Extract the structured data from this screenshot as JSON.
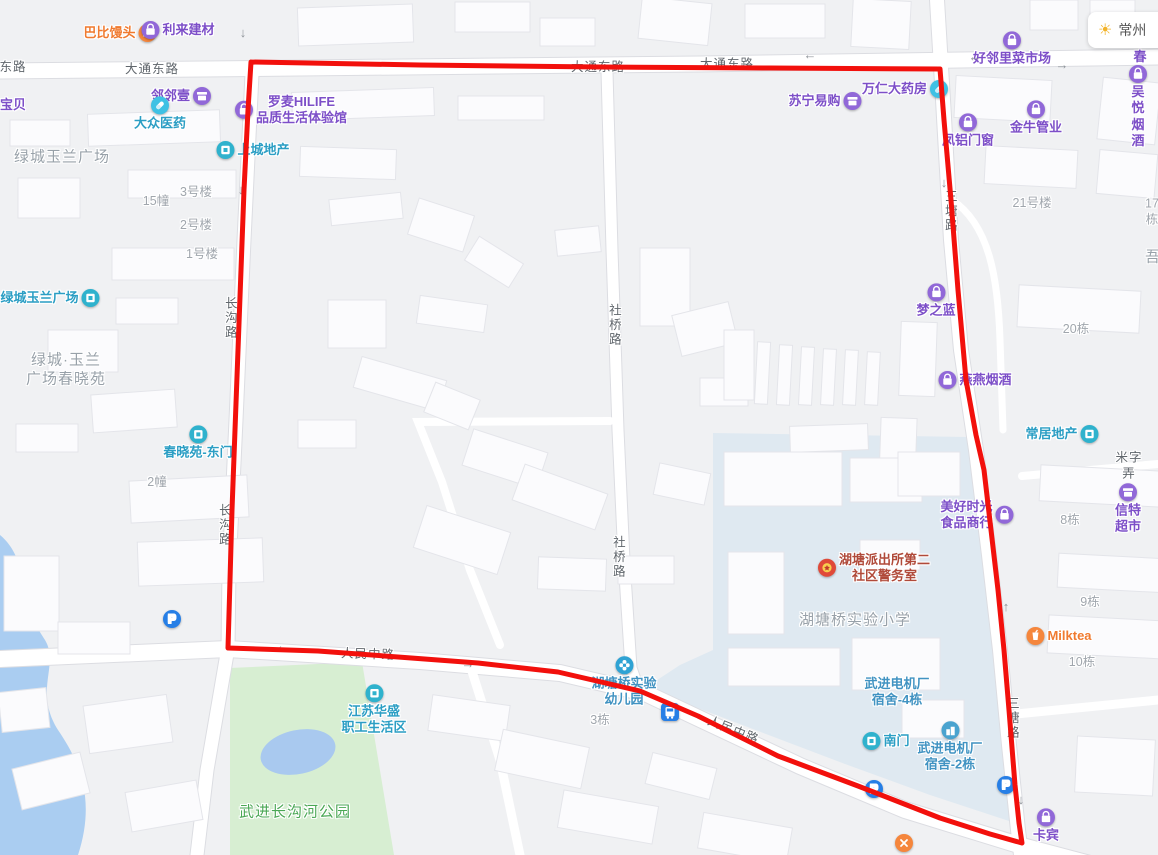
{
  "map": {
    "weather": {
      "city": "常州"
    },
    "colors": {
      "boundary_red": "#f2100c",
      "poi_purple": "#7d4fc8",
      "poi_teal": "#2b9ec4",
      "park_green": "#d7eed2",
      "school_blue": "#dfe9f1",
      "water_blue": "#aacdf1"
    },
    "overlay": {
      "color": "#f2100c",
      "width": "5",
      "points": "251,62 420,65 600,67 770,68 940,69 944,120 951,200 958,290 966,380 976,435 984,470 991,530 998,590 1004,650 1009,710 1015,785 1019,823 1022,843 990,834 940,818 858,786 778,756 698,716 640,691 558,672 478,663 398,657 318,651 228,648 230,580 232,510 235,430 238,350 241,270 244,190 248,110 251,62"
    },
    "labels": [
      {
        "name": "poi-babi-mantou",
        "text": "巴比馒头",
        "x": 120,
        "y": 33,
        "type": "poi-orange",
        "icon": "hand",
        "icon_pos": "right"
      },
      {
        "name": "poi-lilai-jiancai",
        "text": "利来建材",
        "x": 178,
        "y": 30,
        "type": "poi-purple",
        "icon": "bag",
        "icon_pos": "left"
      },
      {
        "name": "road-label-donglu",
        "text": "东路",
        "x": 13,
        "y": 68,
        "type": "road"
      },
      {
        "name": "road-label-datong-donglu-1",
        "text": "大通东路",
        "x": 152,
        "y": 70,
        "type": "road"
      },
      {
        "name": "road-label-datong-donglu-2",
        "text": "大通东路",
        "x": 598,
        "y": 68,
        "type": "road"
      },
      {
        "name": "road-label-datong-donglu-3",
        "text": "大通东路",
        "x": 727,
        "y": 65,
        "type": "road"
      },
      {
        "name": "poi-haolinli-caishichang",
        "text": "好邻里菜市场",
        "x": 1012,
        "y": 49,
        "type": "poi-purple",
        "icon": "bag",
        "icon_pos": "top"
      },
      {
        "name": "poi-tingchun-partial",
        "text": "听春",
        "x": 1140,
        "y": 49,
        "type": "poi-purple"
      },
      {
        "name": "poi-linlinyi",
        "text": "邻邻壹",
        "x": 181,
        "y": 96,
        "type": "poi-purple",
        "icon": "shop",
        "icon_pos": "right"
      },
      {
        "name": "poi-baobei",
        "text": "宝贝",
        "x": 13,
        "y": 105,
        "type": "poi-purple"
      },
      {
        "name": "poi-dazhong-yiyao",
        "text": "大众医药",
        "x": 160,
        "y": 114,
        "type": "poi-teal",
        "icon": "pill",
        "icon_pos": "top"
      },
      {
        "name": "poi-luomai-hilife",
        "text": "罗麦HILIFE\n品质生活体验馆",
        "x": 291,
        "y": 110,
        "type": "poi-purple",
        "icon": "bag",
        "icon_pos": "left"
      },
      {
        "name": "poi-suning-yigou",
        "text": "苏宁易购",
        "x": 825,
        "y": 101,
        "type": "poi-purple",
        "icon": "shop",
        "icon_pos": "right"
      },
      {
        "name": "poi-wanren-dayaofang",
        "text": "万仁大药房",
        "x": 905,
        "y": 89,
        "type": "poi-purple",
        "icon": "pill",
        "icon_pos": "right"
      },
      {
        "name": "poi-fenglv-menchuang",
        "text": "凤铝门窗",
        "x": 968,
        "y": 131,
        "type": "poi-purple",
        "icon": "bag",
        "icon_pos": "top"
      },
      {
        "name": "poi-jinniu-guanye",
        "text": "金牛管业",
        "x": 1036,
        "y": 118,
        "type": "poi-purple",
        "icon": "bag",
        "icon_pos": "top"
      },
      {
        "name": "poi-wuyue-yanjiu",
        "text": "吴悦烟酒",
        "x": 1138,
        "y": 107,
        "type": "poi-purple",
        "icon": "bag",
        "icon_pos": "top"
      },
      {
        "name": "poi-shangcheng-dichan",
        "text": "上城地产",
        "x": 253,
        "y": 150,
        "type": "poi-teal",
        "icon": "door",
        "icon_pos": "left"
      },
      {
        "name": "area-lvcheng-yulan-guangchang",
        "text": "绿城玉兰广场",
        "x": 62,
        "y": 158,
        "type": "area"
      },
      {
        "name": "bldg-3haolou",
        "text": "3号楼",
        "x": 196,
        "y": 193,
        "type": "bldg"
      },
      {
        "name": "bldg-15zhuang",
        "text": "15幢",
        "x": 156,
        "y": 202,
        "type": "bldg"
      },
      {
        "name": "bldg-2haolou",
        "text": "2号楼",
        "x": 196,
        "y": 226,
        "type": "bldg"
      },
      {
        "name": "bldg-1haolou",
        "text": "1号楼",
        "x": 202,
        "y": 255,
        "type": "bldg"
      },
      {
        "name": "poi-lvcheng-yulan-guangchang",
        "text": "绿城玉兰广场",
        "x": 50,
        "y": 298,
        "type": "poi-teal",
        "icon": "door",
        "icon_pos": "right"
      },
      {
        "name": "area-lvcheng-yulan-chunxiaoyuan",
        "text": "绿城·玉兰\n广场春晓苑",
        "x": 66,
        "y": 370,
        "type": "area"
      },
      {
        "name": "road-label-changgoulu-1",
        "text": "长沟路",
        "x": 229,
        "y": 318,
        "type": "road-v"
      },
      {
        "name": "road-label-changgoulu-2",
        "text": "长沟路",
        "x": 223,
        "y": 525,
        "type": "road-v"
      },
      {
        "name": "road-label-sheqiaolu-1",
        "text": "社桥路",
        "x": 613,
        "y": 325,
        "type": "road-v"
      },
      {
        "name": "road-label-sheqiaolu-2",
        "text": "社桥路",
        "x": 617,
        "y": 557,
        "type": "road-v"
      },
      {
        "name": "road-label-santanglu-1",
        "text": "三塘路",
        "x": 949,
        "y": 211,
        "type": "road-v"
      },
      {
        "name": "road-label-santanglu-2",
        "text": "三塘路",
        "x": 1011,
        "y": 718,
        "type": "road-v"
      },
      {
        "name": "poi-chunxiaoyuan-dongmen",
        "text": "春晓苑-东门",
        "x": 198,
        "y": 443,
        "type": "poi-teal",
        "icon": "door",
        "icon_pos": "top"
      },
      {
        "name": "bldg-2zhuang",
        "text": "2幢",
        "x": 157,
        "y": 483,
        "type": "bldg"
      },
      {
        "name": "parking-icon-west",
        "text": "",
        "x": 172,
        "y": 619,
        "type": "icon",
        "icon": "parking"
      },
      {
        "name": "area-wujin-changgouhe-park",
        "text": "武进长沟河公园",
        "x": 295,
        "y": 813,
        "type": "area-green"
      },
      {
        "name": "poi-jiangsu-huasheng",
        "text": "江苏华盛\n职工生活区",
        "x": 374,
        "y": 710,
        "type": "poi-teal",
        "icon": "door",
        "icon_pos": "top"
      },
      {
        "name": "bldg-3dong",
        "text": "3栋",
        "x": 600,
        "y": 721,
        "type": "bldg"
      },
      {
        "name": "poi-hutangqiao-youeryuan",
        "text": "湖塘桥实验\n幼儿园",
        "x": 624,
        "y": 682,
        "type": "poi-blue",
        "icon": "flower",
        "icon_pos": "top"
      },
      {
        "name": "bus-stop-icon",
        "text": "",
        "x": 670,
        "y": 712,
        "type": "icon",
        "icon": "bus"
      },
      {
        "name": "road-label-renmin-zhonglu-1",
        "text": "人民中路",
        "x": 368,
        "y": 655,
        "type": "road",
        "rotate": 2
      },
      {
        "name": "road-label-renmin-zhonglu-2",
        "text": "人民中路",
        "x": 733,
        "y": 731,
        "type": "road",
        "rotate": 22
      },
      {
        "name": "poi-nanmen",
        "text": "南门",
        "x": 886,
        "y": 741,
        "type": "poi-teal",
        "icon": "door",
        "icon_pos": "left"
      },
      {
        "name": "poi-dianjichang-sushe-4dong",
        "text": "武进电机厂\n宿舍-4栋",
        "x": 897,
        "y": 692,
        "type": "poi-blue"
      },
      {
        "name": "poi-dianjichang-sushe-2dong",
        "text": "武进电机厂\n宿舍-2栋",
        "x": 950,
        "y": 747,
        "type": "poi-blue",
        "icon": "building",
        "icon_pos": "top"
      },
      {
        "name": "parking-icon-south",
        "text": "",
        "x": 874,
        "y": 789,
        "type": "icon",
        "icon": "parking"
      },
      {
        "name": "parking-icon-southeast",
        "text": "",
        "x": 1006,
        "y": 785,
        "type": "icon",
        "icon": "parking"
      },
      {
        "name": "road-closed-icon",
        "text": "",
        "x": 904,
        "y": 843,
        "type": "icon",
        "icon": "close"
      },
      {
        "name": "poi-hutang-paichusuo",
        "text": "湖塘派出所第二\n社区警务室",
        "x": 874,
        "y": 568,
        "type": "poi-police",
        "icon": "police",
        "icon_pos": "left"
      },
      {
        "name": "area-hutangqiao-shiyan-xiaoxue",
        "text": "湖塘桥实验小学",
        "x": 855,
        "y": 621,
        "type": "area"
      },
      {
        "name": "poi-mengzhilan",
        "text": "梦之蓝",
        "x": 936,
        "y": 301,
        "type": "poi-purple",
        "icon": "bag",
        "icon_pos": "top"
      },
      {
        "name": "bldg-21haolou",
        "text": "21号楼",
        "x": 1032,
        "y": 204,
        "type": "bldg"
      },
      {
        "name": "bldg-17dong",
        "text": "17栋",
        "x": 1152,
        "y": 212,
        "type": "bldg"
      },
      {
        "name": "area-wu-partial",
        "text": "吾",
        "x": 1153,
        "y": 258,
        "type": "area"
      },
      {
        "name": "bldg-20dong",
        "text": "20栋",
        "x": 1076,
        "y": 330,
        "type": "bldg"
      },
      {
        "name": "poi-yanyan-yanjiu",
        "text": "燕燕烟酒",
        "x": 975,
        "y": 380,
        "type": "poi-purple",
        "icon": "bag",
        "icon_pos": "left"
      },
      {
        "name": "poi-changju-dichan",
        "text": "常居地产",
        "x": 1062,
        "y": 434,
        "type": "poi-teal",
        "icon": "door",
        "icon_pos": "right"
      },
      {
        "name": "road-label-mizilong",
        "text": "米字弄",
        "x": 1129,
        "y": 466,
        "type": "road"
      },
      {
        "name": "poi-meihao-shiguang",
        "text": "美好时光\n食品商行",
        "x": 977,
        "y": 515,
        "type": "poi-purple",
        "icon": "bag",
        "icon_pos": "right"
      },
      {
        "name": "poi-xinte-chaoshi",
        "text": "信特超市",
        "x": 1128,
        "y": 509,
        "type": "poi-purple",
        "icon": "shop",
        "icon_pos": "top"
      },
      {
        "name": "bldg-8dong",
        "text": "8栋",
        "x": 1070,
        "y": 521,
        "type": "bldg"
      },
      {
        "name": "bldg-9dong",
        "text": "9栋",
        "x": 1090,
        "y": 603,
        "type": "bldg"
      },
      {
        "name": "poi-milktea",
        "text": "Milktea",
        "x": 1059,
        "y": 636,
        "type": "poi-orange",
        "icon": "cup",
        "icon_pos": "left"
      },
      {
        "name": "bldg-10dong",
        "text": "10栋",
        "x": 1082,
        "y": 663,
        "type": "bldg"
      },
      {
        "name": "poi-kabin",
        "text": "卡宾",
        "x": 1046,
        "y": 826,
        "type": "poi-purple",
        "icon": "bag",
        "icon_pos": "top"
      },
      {
        "name": "oneway-arrow",
        "text": "↓",
        "x": 243,
        "y": 33,
        "type": "arrow"
      },
      {
        "name": "oneway-arrow",
        "text": "←",
        "x": 810,
        "y": 55,
        "type": "arrow"
      },
      {
        "name": "oneway-arrow",
        "text": "←",
        "x": 975,
        "y": 57,
        "type": "arrow"
      },
      {
        "name": "oneway-arrow",
        "text": "→",
        "x": 1062,
        "y": 65,
        "type": "arrow"
      },
      {
        "name": "oneway-arrow",
        "text": "↓",
        "x": 241,
        "y": 190,
        "type": "arrow"
      },
      {
        "name": "oneway-arrow",
        "text": "↓",
        "x": 944,
        "y": 183,
        "type": "arrow"
      },
      {
        "name": "oneway-arrow",
        "text": "↓",
        "x": 962,
        "y": 328,
        "type": "arrow"
      },
      {
        "name": "oneway-arrow",
        "text": "←",
        "x": 283,
        "y": 646,
        "type": "arrow"
      },
      {
        "name": "oneway-arrow",
        "text": "→",
        "x": 468,
        "y": 664,
        "type": "arrow"
      },
      {
        "name": "oneway-arrow",
        "text": "↑",
        "x": 1006,
        "y": 607,
        "type": "arrow"
      },
      {
        "name": "oneway-arrow",
        "text": "↓",
        "x": 1021,
        "y": 800,
        "type": "arrow"
      }
    ]
  }
}
